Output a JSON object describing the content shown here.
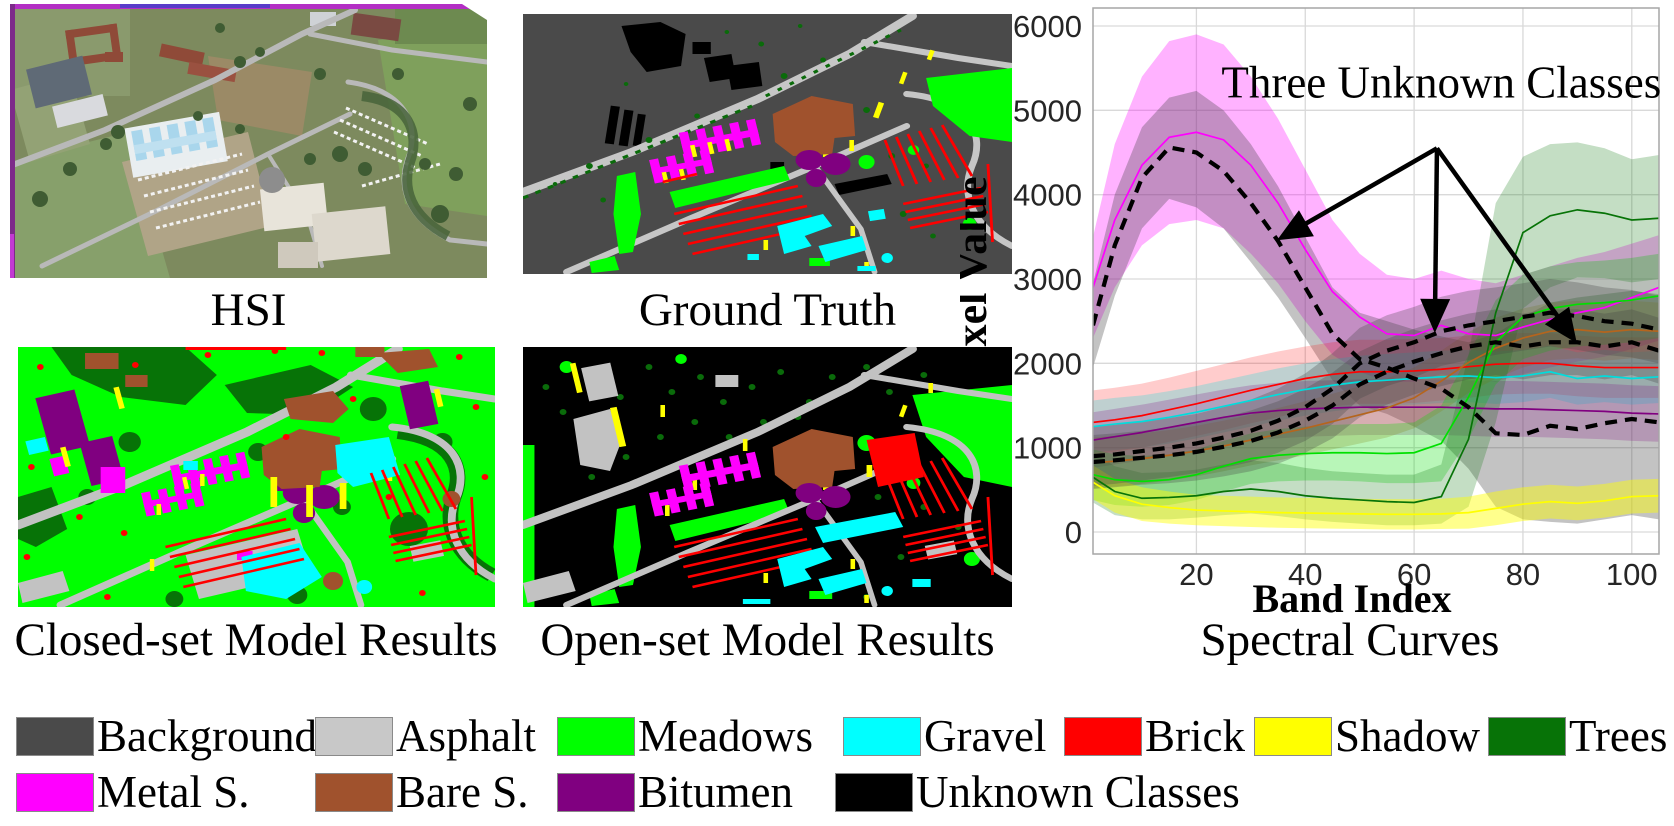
{
  "panels": {
    "hsi": {
      "caption": "HSI"
    },
    "ground_truth": {
      "caption": "Ground Truth"
    },
    "closed_set": {
      "caption": "Closed-set Model Results"
    },
    "open_set": {
      "caption": "Open-set Model Results"
    },
    "chart": {
      "caption": "Spectral Curves"
    }
  },
  "legend": {
    "rows": [
      [
        {
          "label": "Background",
          "color": "#4a4a4a"
        },
        {
          "label": "Asphalt",
          "color": "#c8c8c8"
        },
        {
          "label": "Meadows",
          "color": "#00ff00"
        },
        {
          "label": "Gravel",
          "color": "#00ffff"
        },
        {
          "label": "Brick",
          "color": "#ff0000"
        },
        {
          "label": "Shadow",
          "color": "#ffff00"
        },
        {
          "label": "Trees",
          "color": "#077307"
        }
      ],
      [
        {
          "label": "Metal S.",
          "color": "#ff00ff"
        },
        {
          "label": "Bare S.",
          "color": "#a0522d"
        },
        {
          "label": "Bitumen",
          "color": "#800080"
        },
        {
          "label": "Unknown Classes",
          "color": "#000000"
        }
      ]
    ]
  },
  "chart_data": {
    "type": "line",
    "xlabel": "Band Index",
    "ylabel": "Pixel Value",
    "xlim": [
      1,
      105
    ],
    "ylim": [
      0,
      6200
    ],
    "xticks": [
      20,
      40,
      60,
      80,
      100
    ],
    "yticks": [
      0,
      1000,
      2000,
      3000,
      4000,
      5000,
      6000
    ],
    "grid": true,
    "x": [
      1,
      5,
      10,
      15,
      20,
      25,
      30,
      35,
      40,
      45,
      50,
      55,
      60,
      65,
      70,
      75,
      80,
      85,
      90,
      95,
      100,
      105
    ],
    "series": [
      {
        "name": "Metal S.",
        "color": "#ff00ff",
        "dashed": false,
        "fill_opacity": 0.3,
        "mean": [
          2900,
          3700,
          4350,
          4680,
          4740,
          4650,
          4350,
          3900,
          3350,
          2850,
          2550,
          2350,
          2330,
          2450,
          2350,
          2330,
          2430,
          2520,
          2600,
          2660,
          2780,
          2900
        ],
        "upper": [
          3500,
          4600,
          5400,
          5820,
          5900,
          5780,
          5400,
          4900,
          4300,
          3700,
          3300,
          3050,
          3000,
          3100,
          3000,
          2950,
          3050,
          3150,
          3250,
          3320,
          3420,
          3520
        ],
        "lower": [
          2300,
          2900,
          3400,
          3650,
          3700,
          3600,
          3300,
          2950,
          2500,
          2100,
          1900,
          1780,
          1780,
          1870,
          1820,
          1780,
          1870,
          1950,
          2020,
          2080,
          2170,
          2270
        ]
      },
      {
        "name": "Unknown 1",
        "color": "#000000",
        "fill_color": "#444444",
        "dashed": true,
        "fill_opacity": 0.32,
        "mean": [
          2450,
          3400,
          4200,
          4560,
          4500,
          4280,
          3900,
          3450,
          2900,
          2350,
          2050,
          1950,
          1820,
          1700,
          1480,
          1170,
          1150,
          1260,
          1220,
          1290,
          1340,
          1300
        ],
        "upper": [
          2950,
          4000,
          4800,
          5150,
          5230,
          5000,
          4600,
          4100,
          3500,
          2900,
          2600,
          2500,
          2400,
          2320,
          2250,
          2350,
          2550,
          2720,
          2780,
          2820,
          2860,
          2820
        ],
        "lower": [
          1950,
          2800,
          3600,
          3950,
          3850,
          3600,
          3200,
          2780,
          2300,
          1800,
          1500,
          1400,
          1250,
          1080,
          750,
          300,
          150,
          120,
          100,
          150,
          200,
          150
        ]
      },
      {
        "name": "Brick",
        "color": "#ff0000",
        "dashed": false,
        "fill_opacity": 0.2,
        "mean": [
          1300,
          1330,
          1380,
          1450,
          1520,
          1600,
          1680,
          1750,
          1820,
          1870,
          1900,
          1900,
          1910,
          1930,
          1960,
          1990,
          2000,
          2000,
          1970,
          1950,
          1950,
          1950
        ],
        "upper": [
          1680,
          1710,
          1760,
          1830,
          1910,
          1990,
          2070,
          2140,
          2200,
          2250,
          2280,
          2280,
          2290,
          2300,
          2330,
          2350,
          2360,
          2360,
          2330,
          2310,
          2310,
          2310
        ],
        "lower": [
          920,
          950,
          1000,
          1070,
          1140,
          1210,
          1290,
          1360,
          1440,
          1490,
          1520,
          1520,
          1530,
          1560,
          1590,
          1630,
          1640,
          1640,
          1610,
          1590,
          1590,
          1590
        ]
      },
      {
        "name": "Gravel",
        "color": "#00dddd",
        "dashed": false,
        "fill_opacity": 0.25,
        "mean": [
          1250,
          1280,
          1310,
          1360,
          1420,
          1490,
          1560,
          1630,
          1690,
          1740,
          1780,
          1800,
          1820,
          1840,
          1850,
          1830,
          1850,
          1900,
          1820,
          1850,
          1820,
          1840
        ],
        "upper": [
          1560,
          1590,
          1620,
          1670,
          1730,
          1800,
          1870,
          1940,
          2000,
          2050,
          2090,
          2110,
          2130,
          2150,
          2160,
          2140,
          2160,
          2210,
          2130,
          2160,
          2130,
          2150
        ],
        "lower": [
          940,
          970,
          1000,
          1050,
          1110,
          1180,
          1250,
          1320,
          1380,
          1430,
          1470,
          1490,
          1510,
          1530,
          1540,
          1520,
          1540,
          1590,
          1510,
          1540,
          1510,
          1530
        ]
      },
      {
        "name": "Bitumen",
        "color": "#800080",
        "dashed": false,
        "fill_opacity": 0.22,
        "mean": [
          1090,
          1130,
          1180,
          1240,
          1300,
          1360,
          1410,
          1440,
          1460,
          1470,
          1480,
          1480,
          1480,
          1480,
          1470,
          1460,
          1460,
          1450,
          1440,
          1430,
          1410,
          1400
        ],
        "upper": [
          1420,
          1460,
          1510,
          1570,
          1630,
          1690,
          1740,
          1770,
          1790,
          1800,
          1810,
          1810,
          1810,
          1810,
          1800,
          1790,
          1790,
          1780,
          1770,
          1760,
          1740,
          1730
        ],
        "lower": [
          760,
          800,
          850,
          910,
          970,
          1030,
          1080,
          1110,
          1130,
          1140,
          1150,
          1150,
          1150,
          1150,
          1140,
          1130,
          1130,
          1120,
          1110,
          1100,
          1080,
          1070
        ]
      },
      {
        "name": "Bare S.",
        "color": "#b5651d",
        "dashed": false,
        "fill_opacity": 0.25,
        "mean": [
          820,
          840,
          870,
          910,
          960,
          1020,
          1090,
          1160,
          1230,
          1310,
          1390,
          1470,
          1590,
          1790,
          2010,
          2180,
          2300,
          2380,
          2400,
          2370,
          2400,
          2380
        ],
        "upper": [
          1120,
          1140,
          1170,
          1210,
          1260,
          1320,
          1390,
          1470,
          1550,
          1640,
          1730,
          1820,
          1950,
          2150,
          2370,
          2540,
          2650,
          2720,
          2740,
          2710,
          2740,
          2720
        ],
        "lower": [
          520,
          540,
          570,
          610,
          660,
          720,
          790,
          850,
          910,
          980,
          1050,
          1120,
          1230,
          1430,
          1650,
          1820,
          1950,
          2040,
          2060,
          2030,
          2060,
          2040
        ]
      },
      {
        "name": "Meadows",
        "color": "#00e000",
        "dashed": false,
        "fill_opacity": 0.28,
        "mean": [
          680,
          620,
          600,
          620,
          680,
          780,
          870,
          910,
          930,
          940,
          940,
          930,
          940,
          1050,
          1600,
          2250,
          2550,
          2650,
          2700,
          2720,
          2750,
          2800
        ],
        "upper": [
          980,
          920,
          900,
          920,
          980,
          1080,
          1170,
          1220,
          1250,
          1270,
          1280,
          1280,
          1300,
          1500,
          2100,
          2750,
          3050,
          3150,
          3200,
          3220,
          3250,
          3300
        ],
        "lower": [
          380,
          320,
          300,
          320,
          380,
          480,
          570,
          600,
          610,
          610,
          600,
          580,
          580,
          600,
          1100,
          1750,
          2050,
          2150,
          2200,
          2220,
          2250,
          2300
        ]
      },
      {
        "name": "Trees",
        "color": "#077307",
        "dashed": false,
        "fill_opacity": 0.24,
        "mean": [
          650,
          480,
          400,
          410,
          430,
          480,
          510,
          480,
          430,
          400,
          380,
          360,
          350,
          420,
          1100,
          2600,
          3550,
          3750,
          3820,
          3780,
          3700,
          3720
        ],
        "upper": [
          950,
          780,
          700,
          710,
          740,
          800,
          850,
          820,
          760,
          720,
          700,
          680,
          680,
          800,
          2100,
          3900,
          4450,
          4600,
          4620,
          4550,
          4420,
          4470
        ],
        "lower": [
          350,
          200,
          150,
          150,
          170,
          200,
          220,
          190,
          150,
          120,
          100,
          80,
          80,
          100,
          300,
          1300,
          2650,
          2900,
          3020,
          3010,
          2960,
          3000
        ]
      },
      {
        "name": "Shadow",
        "color": "#ffff00",
        "dashed": false,
        "fill_opacity": 0.45,
        "mean": [
          590,
          430,
          330,
          290,
          260,
          250,
          240,
          230,
          225,
          220,
          215,
          210,
          210,
          215,
          230,
          280,
          330,
          360,
          340,
          370,
          420,
          430
        ],
        "upper": [
          790,
          630,
          530,
          480,
          440,
          430,
          420,
          410,
          405,
          400,
          395,
          390,
          390,
          395,
          420,
          480,
          530,
          560,
          540,
          570,
          620,
          630
        ],
        "lower": [
          390,
          230,
          130,
          100,
          80,
          70,
          60,
          50,
          45,
          40,
          35,
          30,
          30,
          35,
          40,
          80,
          130,
          160,
          140,
          170,
          220,
          230
        ]
      },
      {
        "name": "Unknown 2",
        "color": "#000000",
        "fill_color": "#444444",
        "dashed": true,
        "fill_opacity": 0.3,
        "mean": [
          900,
          920,
          960,
          1000,
          1050,
          1120,
          1200,
          1320,
          1480,
          1700,
          2000,
          2150,
          2250,
          2380,
          2450,
          2500,
          2550,
          2600,
          2560,
          2500,
          2470,
          2400
        ],
        "upper": [
          1250,
          1270,
          1310,
          1350,
          1400,
          1480,
          1570,
          1700,
          1880,
          2120,
          2420,
          2570,
          2670,
          2790,
          2860,
          2900,
          2950,
          3000,
          2960,
          2900,
          2870,
          2800
        ],
        "lower": [
          550,
          570,
          610,
          650,
          700,
          760,
          830,
          940,
          1080,
          1280,
          1580,
          1730,
          1830,
          1970,
          2040,
          2100,
          2150,
          2200,
          2160,
          2100,
          2070,
          2000
        ]
      },
      {
        "name": "Unknown 3",
        "color": "#000000",
        "fill_color": "#444444",
        "dashed": true,
        "fill_opacity": 0.3,
        "mean": [
          830,
          850,
          880,
          910,
          950,
          1010,
          1080,
          1180,
          1320,
          1500,
          1750,
          1900,
          2020,
          2120,
          2200,
          2250,
          2200,
          2250,
          2250,
          2200,
          2250,
          2150
        ],
        "upper": [
          1150,
          1170,
          1200,
          1240,
          1290,
          1360,
          1440,
          1550,
          1700,
          1890,
          2140,
          2290,
          2410,
          2510,
          2590,
          2640,
          2590,
          2640,
          2640,
          2590,
          2640,
          2540
        ],
        "lower": [
          510,
          530,
          560,
          580,
          610,
          660,
          720,
          810,
          940,
          1110,
          1360,
          1510,
          1630,
          1730,
          1810,
          1860,
          1810,
          1860,
          1860,
          1810,
          1860,
          1760
        ]
      }
    ],
    "annotation": {
      "label": "Three Unknown Classes",
      "anchor": [
        65,
        5150
      ],
      "origin": [
        64.2,
        4550
      ],
      "targets": [
        [
          34.8,
          3460
        ],
        [
          63.8,
          2360
        ],
        [
          89.9,
          2240
        ]
      ]
    }
  }
}
